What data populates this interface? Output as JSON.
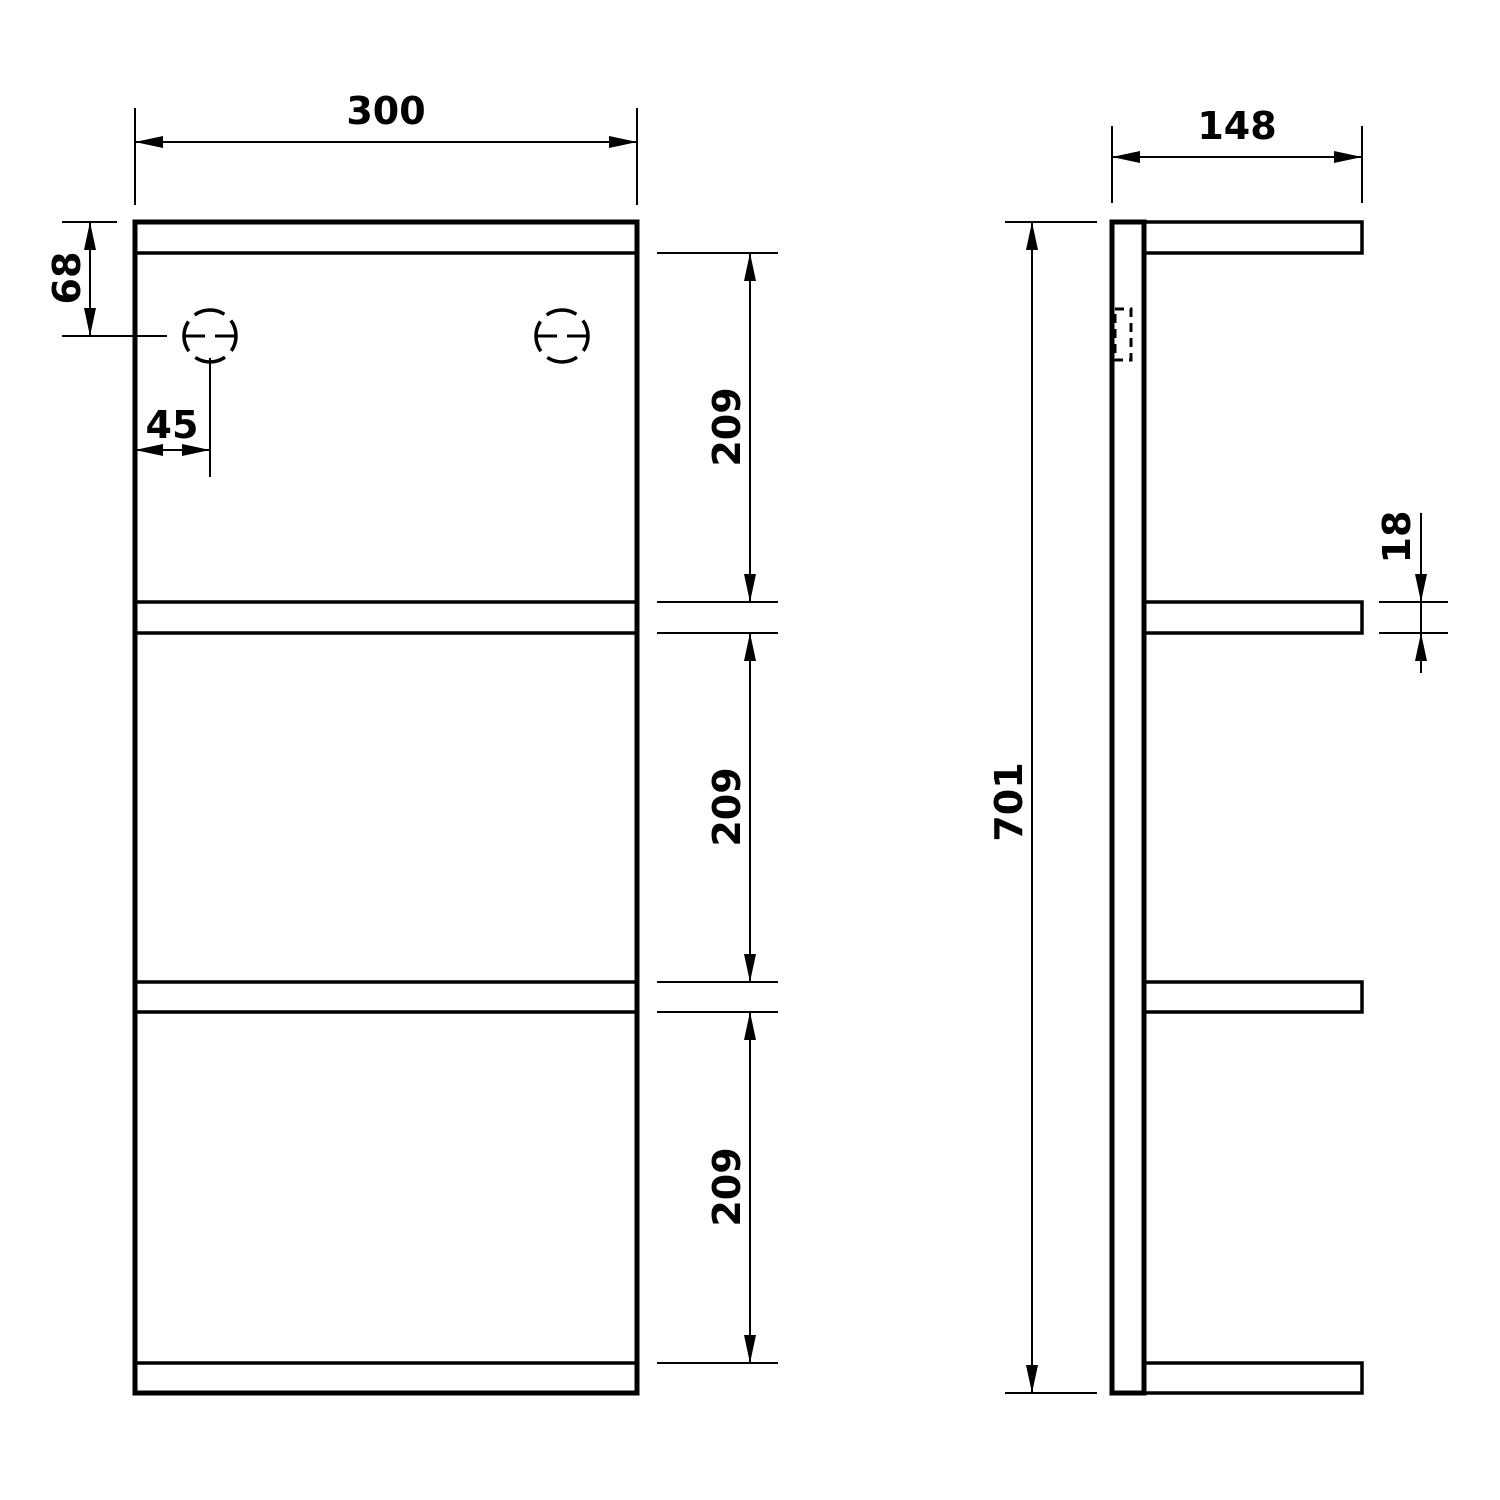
{
  "colors": {
    "line": "#000000",
    "background": "#ffffff"
  },
  "dimensions": {
    "width": "300",
    "depth": "148",
    "height": "701",
    "hole_offset_top": "68",
    "hole_offset_side": "45",
    "compartment_top": "209",
    "compartment_middle": "209",
    "compartment_bottom": "209",
    "shelf_thickness": "18"
  }
}
